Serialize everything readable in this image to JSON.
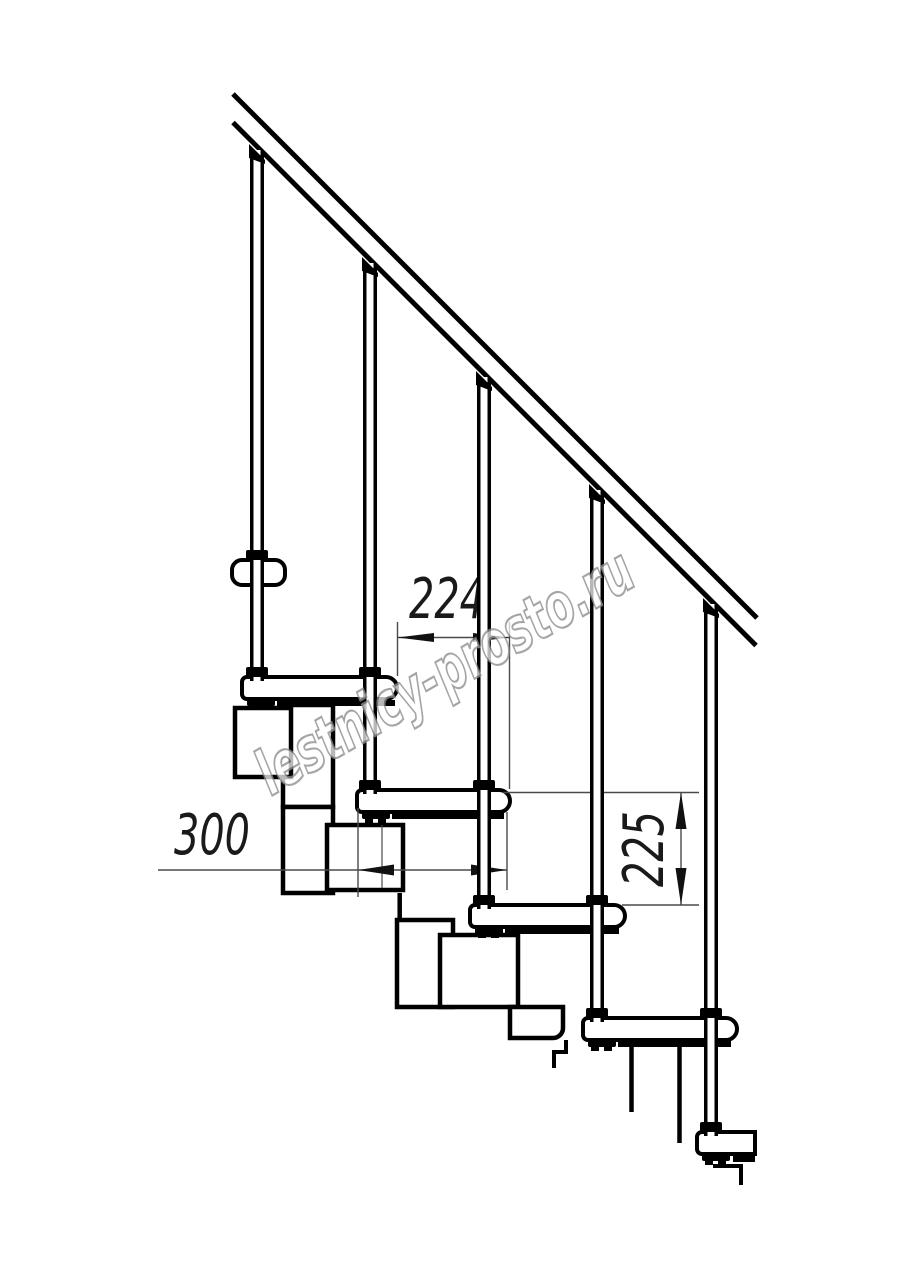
{
  "drawing": {
    "background": "#ffffff",
    "line_color": "#000000",
    "dim_color": "#4a4a4a",
    "dimensions": {
      "tread_depth": {
        "value": "224",
        "orientation": "horizontal"
      },
      "step_length": {
        "value": "300",
        "orientation": "horizontal"
      },
      "riser_height": {
        "value": "225",
        "orientation": "vertical-rotated"
      }
    },
    "watermark": {
      "text": "lestnicy-prosto.ru",
      "color": "#8f8f8f"
    }
  }
}
